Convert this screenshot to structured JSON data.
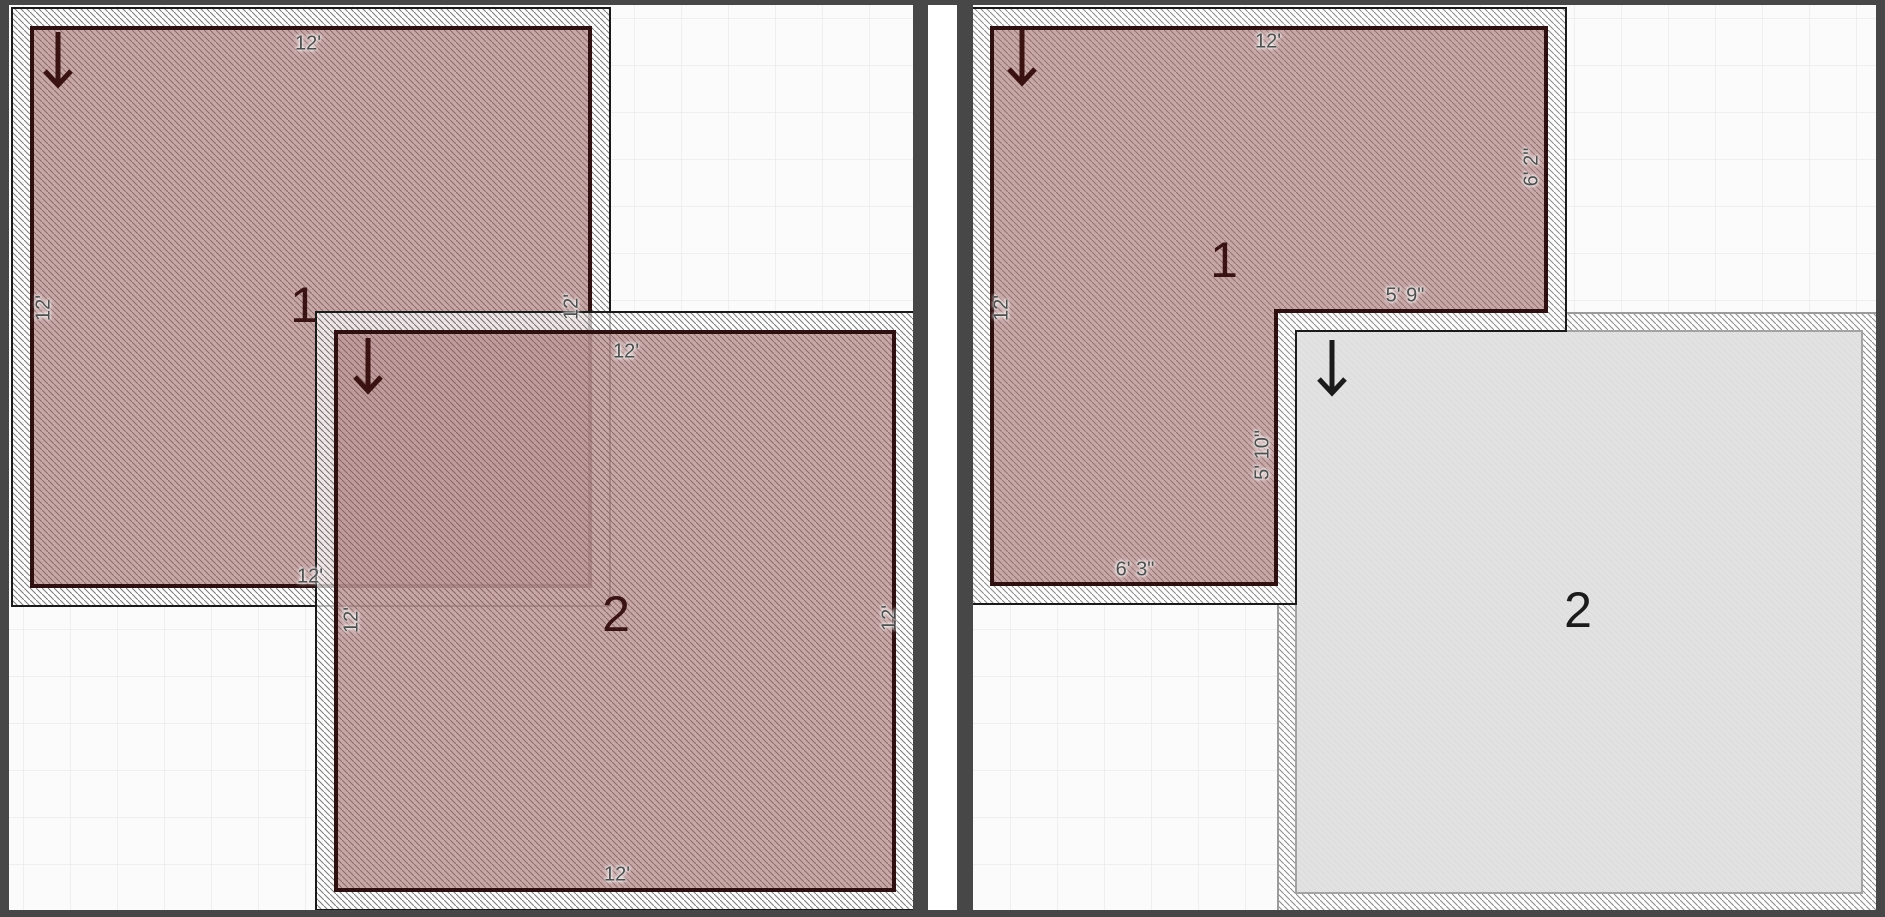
{
  "panels": {
    "before": {
      "room1": {
        "number": "1",
        "dims": {
          "top": "12'",
          "left": "12'",
          "right": "12'",
          "bottom": "12'"
        }
      },
      "room2": {
        "number": "2",
        "dims": {
          "top": "12'",
          "left": "12'",
          "right": "12'",
          "bottom": "12'"
        }
      }
    },
    "after": {
      "room1": {
        "number": "1",
        "dims": {
          "top": "12'",
          "left": "12'",
          "right_upper": "6' 2\"",
          "notch_width": "5' 9\"",
          "notch_height": "5' 10\"",
          "bottom_left": "6' 3\""
        }
      },
      "room2": {
        "number": "2"
      }
    }
  },
  "icons": {
    "door_direction": "down-arrow"
  },
  "colors": {
    "frame": "#474747",
    "canvas_bg": "#fbfbfb",
    "grid_line": "#ebebeb",
    "room_fill": "rgba(155,95,95,0.55)",
    "room_overlap": "#ae7e7e",
    "room2_after_fill": "#e0e0e0",
    "wall_inner_line": "#2e1010",
    "dim_text": "#4f4f4f",
    "number_maroon": "#3a1414",
    "number_black": "#1b1b1b"
  }
}
